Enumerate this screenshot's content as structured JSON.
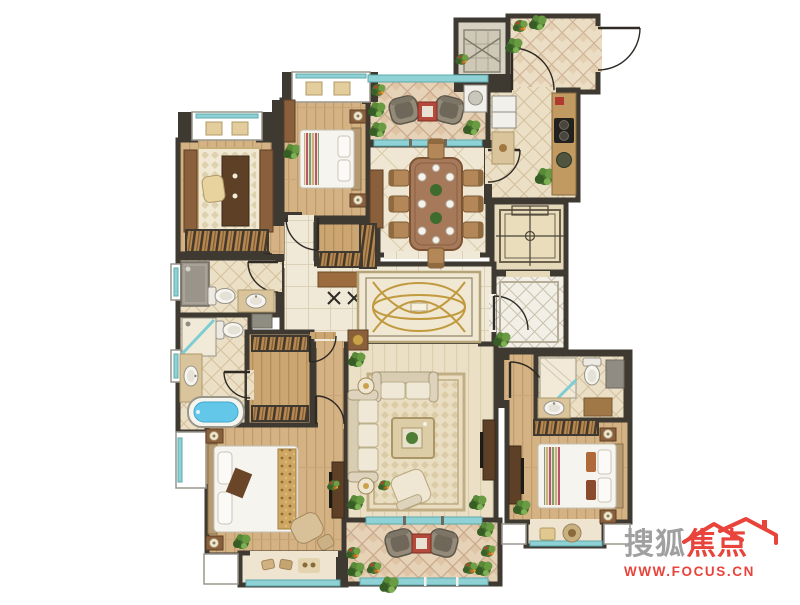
{
  "watermark": {
    "brand_gray_text": "搜狐",
    "brand_red_text": "焦点",
    "url_text": "WWW.FOCUS.CN",
    "gray_color": "#a0a0a0",
    "red_color": "#e8443c"
  },
  "floorplan": {
    "type": "residential-apartment-floor-plan",
    "rooms": [
      "study",
      "bedroom-2",
      "laundry-balcony",
      "dining-room",
      "elevator-1",
      "entry-porch",
      "kitchen",
      "elevator-2",
      "elevator-lobby",
      "hallway",
      "guest-bathroom",
      "master-bathroom",
      "walk-in-closet",
      "corridor",
      "master-bedroom",
      "master-balcony",
      "living-room",
      "view-balcony",
      "bedroom-3",
      "ensuite-bathroom",
      "bay-window-3"
    ],
    "palette": {
      "wall": "#3e3931",
      "wood_floor": "#d4b283",
      "pale_floor": "#ebe0c6",
      "tile_floor": "#f0e9d7",
      "diamond_tile": "#ebdfc5",
      "balcony_tile": "#e6d2b7",
      "glass": "#8fd2d6",
      "plant_green": "#5d8f3d",
      "accent_table_red": "#b34a3c",
      "bathtub_water": "#62c7e8",
      "rug_gold": "#c19a3f"
    }
  }
}
